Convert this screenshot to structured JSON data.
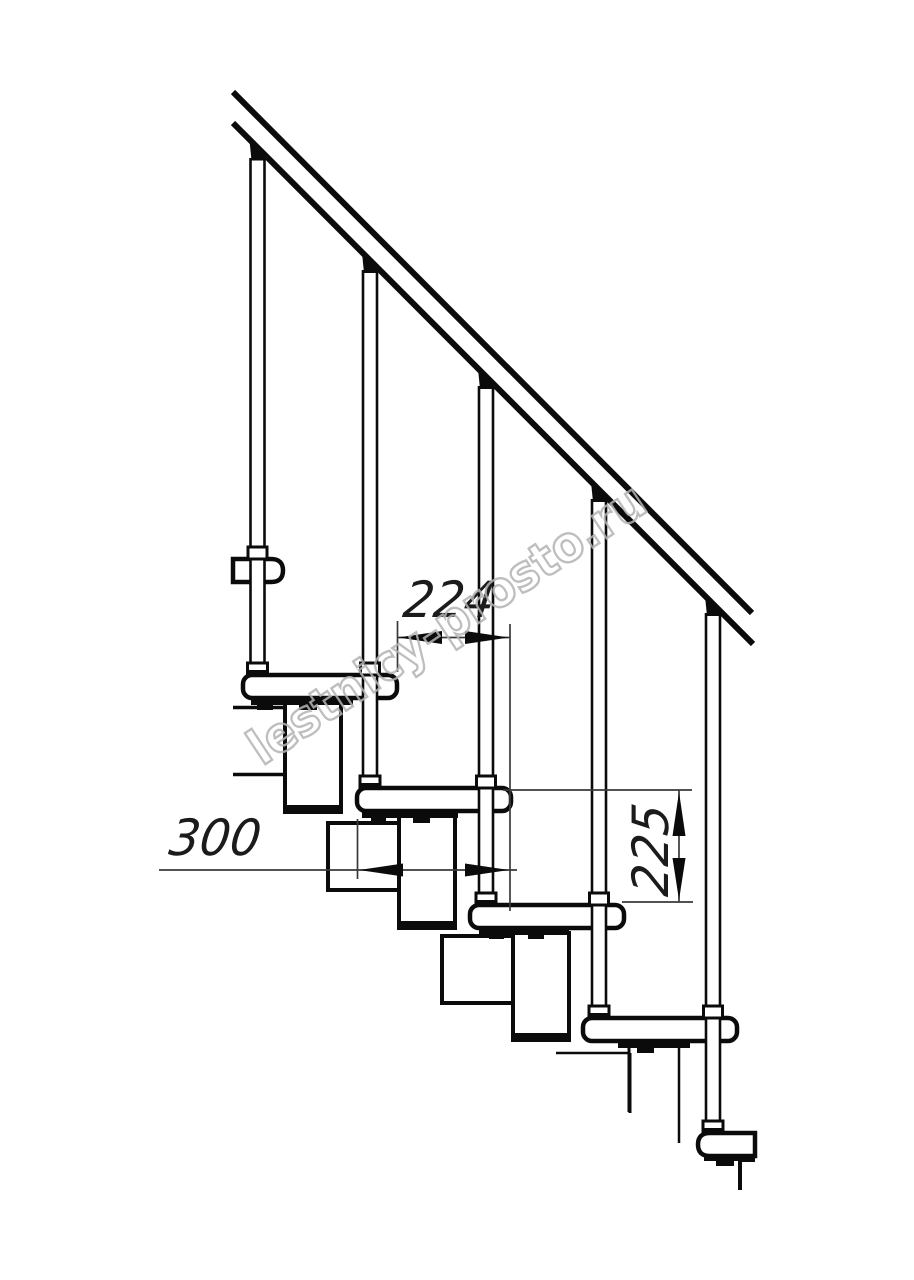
{
  "drawing": {
    "subject": "modular-staircase-side-elevation",
    "ink_color": "#0b0b0b",
    "dim_line_color": "#3a3a3a",
    "background": "#ffffff",
    "treads_visible": 7,
    "balusters_visible": 5
  },
  "dimensions": {
    "step_run": {
      "label": "224"
    },
    "tread_depth": {
      "label": "300"
    },
    "rise_height": {
      "label": "225"
    }
  },
  "watermark": {
    "text": "lestnicy-prosto.ru",
    "color": "#b3b3b3"
  }
}
